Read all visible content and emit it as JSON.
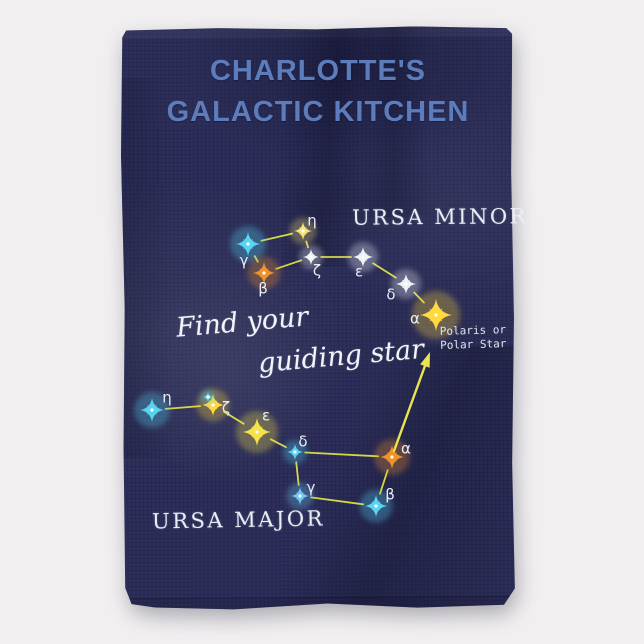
{
  "page": {
    "background": "#f1eff0"
  },
  "towel": {
    "fabric_color": "#2d2f5a",
    "title_line1": "CHARLOTTE'S",
    "title_line2": "GALACTIC KITCHEN",
    "title_color": "#5d7cbc",
    "script_line1": "Find your",
    "script_line2": "guiding star",
    "polaris_note_line1": "Polaris or",
    "polaris_note_line2": "Polar Star"
  },
  "design": {
    "line_color": "#dfe045",
    "arrow_color": "#e9e552",
    "label_color": "#e9edf6"
  },
  "arrow": {
    "from": [
      394,
      451
    ],
    "to": [
      430,
      352
    ]
  },
  "constellations": [
    {
      "id": "ursa-minor",
      "label": "URSA MINOR",
      "stars": [
        {
          "name": "eta",
          "greek": "η",
          "x": 303,
          "y": 231,
          "color": "#f2e47c",
          "size": 9,
          "label_dx": 9,
          "label_dy": -10
        },
        {
          "name": "gamma",
          "greek": "γ",
          "x": 248,
          "y": 244,
          "color": "#57d4f2",
          "size": 12,
          "label_dx": -4,
          "label_dy": 17
        },
        {
          "name": "beta",
          "greek": "β",
          "x": 264,
          "y": 273,
          "color": "#f0922b",
          "size": 11,
          "label_dx": -1,
          "label_dy": 16
        },
        {
          "name": "zeta",
          "greek": "ζ",
          "x": 311,
          "y": 257,
          "color": "#eef1f8",
          "size": 8,
          "label_dx": 6,
          "label_dy": 14
        },
        {
          "name": "epsilon",
          "greek": "ε",
          "x": 363,
          "y": 257,
          "color": "#eef1f8",
          "size": 10,
          "label_dx": -4,
          "label_dy": 15
        },
        {
          "name": "delta",
          "greek": "δ",
          "x": 406,
          "y": 284,
          "color": "#eef1f8",
          "size": 10,
          "label_dx": -15,
          "label_dy": 11
        },
        {
          "name": "alpha",
          "greek": "α",
          "x": 436,
          "y": 315,
          "color": "#ffd93d",
          "size": 16,
          "label_dx": -21,
          "label_dy": 4
        }
      ],
      "lines": [
        [
          "gamma",
          "eta"
        ],
        [
          "eta",
          "zeta"
        ],
        [
          "gamma",
          "beta"
        ],
        [
          "beta",
          "zeta"
        ],
        [
          "zeta",
          "epsilon"
        ],
        [
          "epsilon",
          "delta"
        ],
        [
          "delta",
          "alpha"
        ]
      ]
    },
    {
      "id": "ursa-major",
      "label": "URSA MAJOR",
      "stars": [
        {
          "name": "eta",
          "greek": "η",
          "x": 152,
          "y": 410,
          "color": "#57d4f2",
          "size": 12,
          "label_dx": 15,
          "label_dy": -12,
          "companion": null
        },
        {
          "name": "zeta",
          "greek": "ζ",
          "x": 213,
          "y": 405,
          "color": "#ffd93d",
          "size": 11,
          "label_dx": 13,
          "label_dy": 3,
          "companion": {
            "dx": -5,
            "dy": -8,
            "color": "#57d4f2",
            "size": 5
          }
        },
        {
          "name": "epsilon",
          "greek": "ε",
          "x": 257,
          "y": 432,
          "color": "#f5e14a",
          "size": 14,
          "label_dx": 9,
          "label_dy": -16,
          "companion": null
        },
        {
          "name": "delta",
          "greek": "δ",
          "x": 295,
          "y": 452,
          "color": "#57d4f2",
          "size": 8,
          "label_dx": 8,
          "label_dy": -10,
          "companion": null
        },
        {
          "name": "alpha",
          "greek": "α",
          "x": 392,
          "y": 457,
          "color": "#f0922b",
          "size": 12,
          "label_dx": 14,
          "label_dy": -8,
          "companion": null
        },
        {
          "name": "beta",
          "greek": "β",
          "x": 376,
          "y": 506,
          "color": "#57d4f2",
          "size": 11,
          "label_dx": 14,
          "label_dy": -11,
          "companion": null
        },
        {
          "name": "gamma",
          "greek": "γ",
          "x": 300,
          "y": 496,
          "color": "#6fc8f0",
          "size": 9,
          "label_dx": 11,
          "label_dy": -8,
          "companion": null
        }
      ],
      "lines": [
        [
          "eta",
          "zeta"
        ],
        [
          "zeta",
          "epsilon"
        ],
        [
          "epsilon",
          "delta"
        ],
        [
          "delta",
          "alpha"
        ],
        [
          "delta",
          "gamma"
        ],
        [
          "gamma",
          "beta"
        ],
        [
          "beta",
          "alpha"
        ]
      ]
    }
  ]
}
